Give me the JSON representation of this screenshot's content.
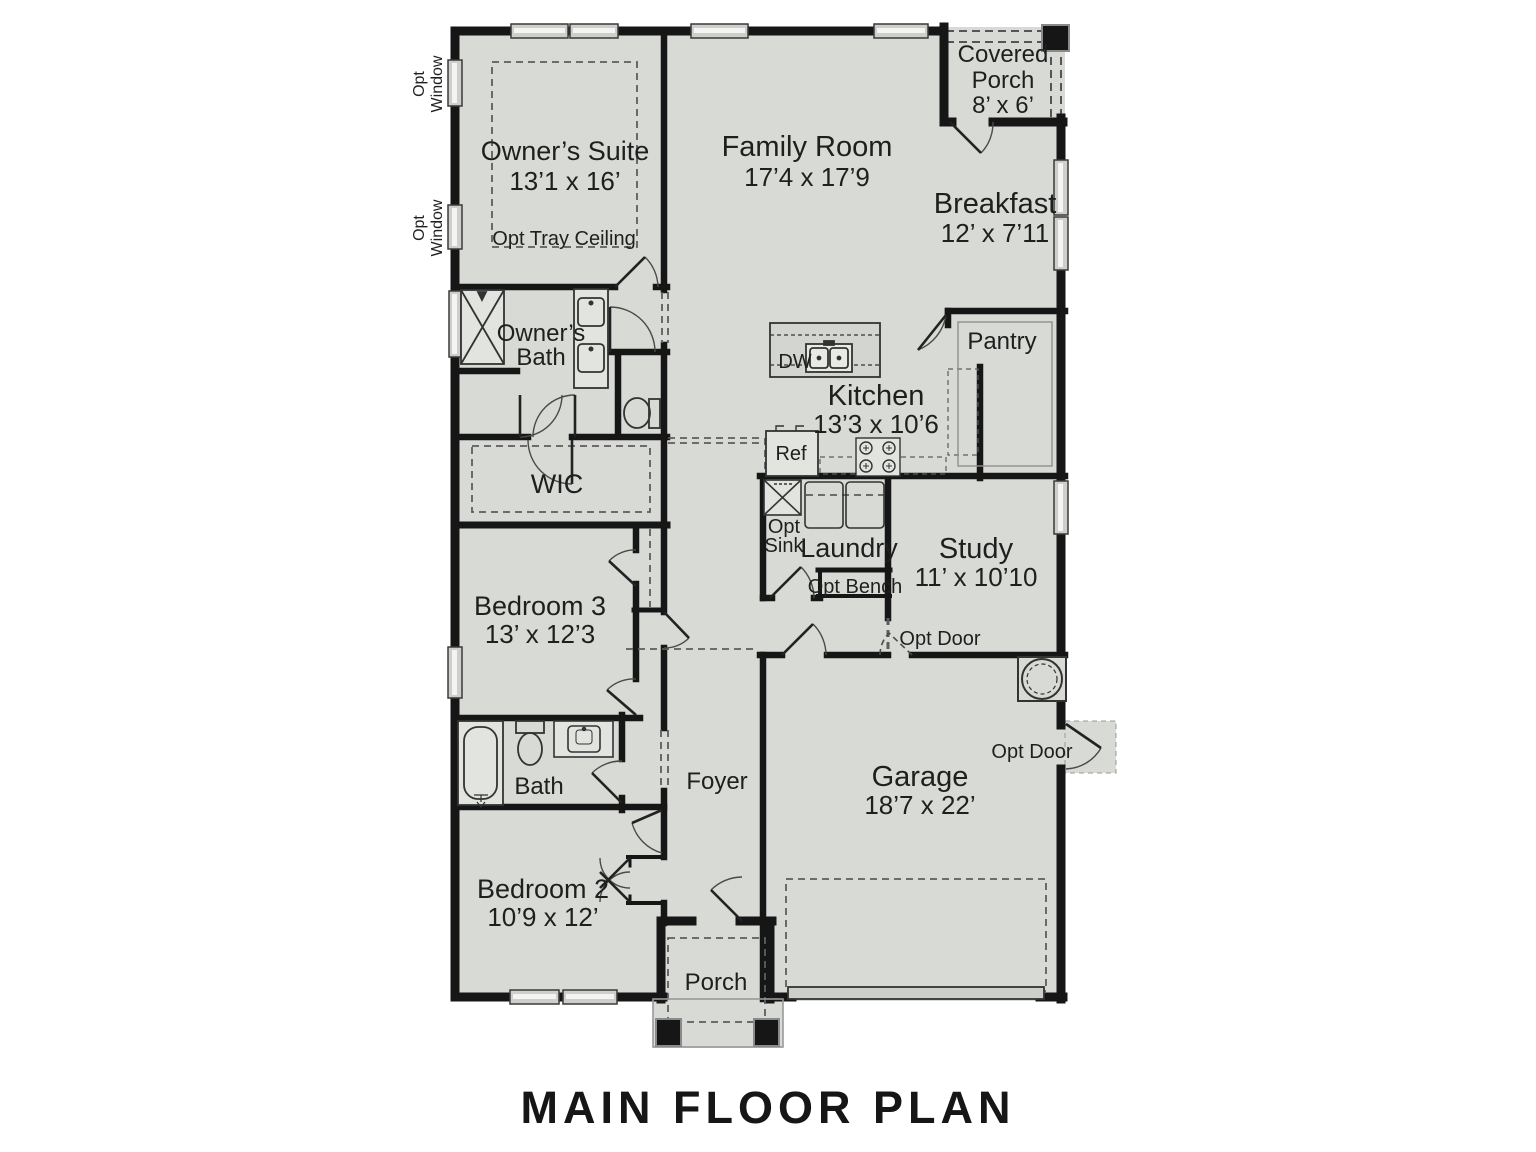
{
  "title": "MAIN FLOOR PLAN",
  "rooms": {
    "owners_suite": {
      "name": "Owner’s Suite",
      "dims": "13’1 x 16’",
      "note": "Opt Tray Ceiling"
    },
    "family_room": {
      "name": "Family Room",
      "dims": "17’4 x 17’9"
    },
    "covered_porch": {
      "line1": "Covered",
      "line2": "Porch",
      "dims": "8’ x 6’"
    },
    "breakfast": {
      "name": "Breakfast",
      "dims": "12’ x 7’11"
    },
    "pantry": {
      "name": "Pantry"
    },
    "kitchen": {
      "name": "Kitchen",
      "dims": "13’3 x 10’6"
    },
    "owners_bath": {
      "line1": "Owner’s",
      "line2": "Bath"
    },
    "wic": {
      "name": "WIC"
    },
    "bedroom3": {
      "name": "Bedroom 3",
      "dims": "13’ x 12’3"
    },
    "laundry": {
      "name": "Laundry"
    },
    "study": {
      "name": "Study",
      "dims": "11’ x 10’10"
    },
    "bath": {
      "name": "Bath"
    },
    "foyer": {
      "name": "Foyer"
    },
    "bedroom2": {
      "name": "Bedroom 2",
      "dims": "10’9 x 12’"
    },
    "garage": {
      "name": "Garage",
      "dims": "18’7 x 22’"
    },
    "porch": {
      "name": "Porch"
    }
  },
  "labels": {
    "opt_window_line1": "Opt",
    "opt_window_line2": "Window",
    "dw": "DW",
    "ref": "Ref",
    "opt_sink_line1": "Opt",
    "opt_sink_line2": "Sink",
    "opt_bench": "Opt Bench",
    "opt_door": "Opt Door"
  },
  "colors": {
    "floor": "#d8dad5",
    "wall": "#161616",
    "dash": "#666666",
    "window_fill": "#cdcfcb",
    "text": "#1f1f1f",
    "background": "#ffffff"
  }
}
